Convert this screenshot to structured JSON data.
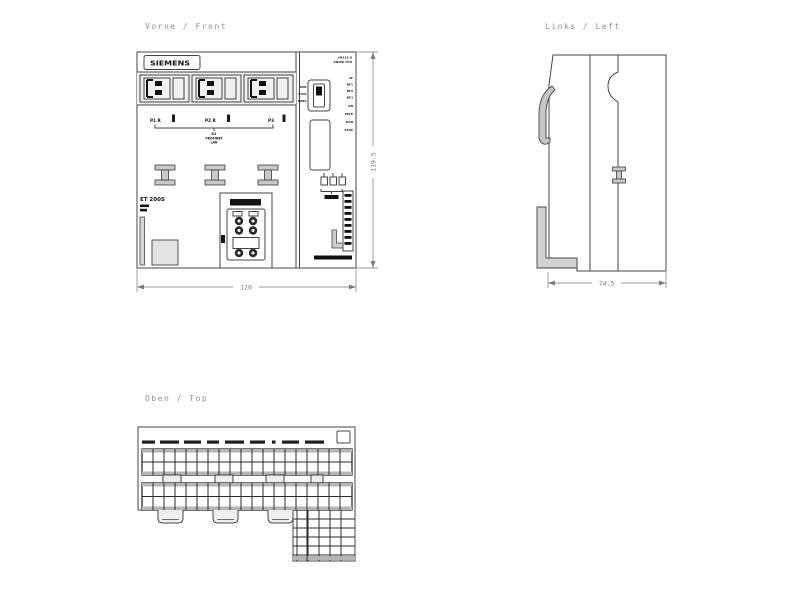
{
  "drawing": {
    "front": {
      "title": "Vorne / Front",
      "brand": "SIEMENS",
      "module_name": "ET 200S",
      "ports": [
        "P1 R",
        "P2 R",
        "P3"
      ],
      "interface_id": "X1",
      "interface_name": "PROFINET",
      "interface_sub": "LAN",
      "cpu_line1": "IM151-8",
      "cpu_line2": "PN/DP CPU",
      "switch_labels": [
        "RUN",
        "STOP",
        "MRES"
      ],
      "led_labels": [
        "SF",
        "BF1",
        "BF2",
        "BF3",
        "ON",
        "FRCE",
        "RUN",
        "STOP"
      ],
      "width_mm": "120",
      "height_mm": "119.5"
    },
    "left": {
      "title": "Links / Left",
      "depth_mm": "74.5"
    },
    "top": {
      "title": "Oben / Top"
    }
  },
  "colors": {
    "background": "#ffffff",
    "outline": "#454545",
    "dark_fill": "#141414",
    "gray_fill": "#c6c6c6",
    "label_text": "#8f8f8f",
    "dimension": "#7a7a7a"
  }
}
